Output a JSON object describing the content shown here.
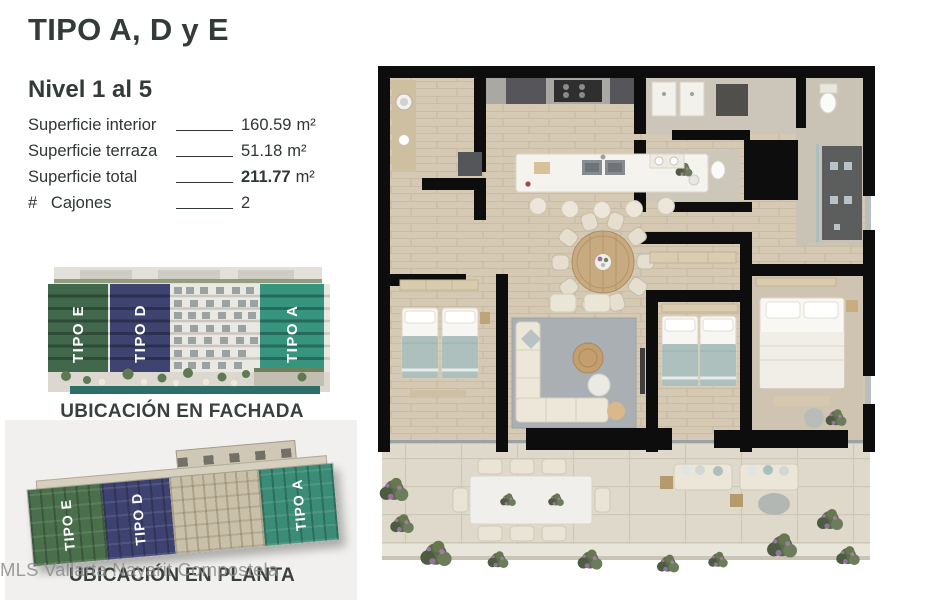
{
  "header": {
    "title": "TIPO A, D y E",
    "subtitle": "Nivel 1 al 5"
  },
  "specs": [
    {
      "label": "Superficie interior",
      "value": "160.59",
      "unit": "m²"
    },
    {
      "label": "Superficie terraza",
      "value": "51.18",
      "unit": "m²"
    },
    {
      "label": "Superficie total",
      "value": "211.77",
      "unit": "m²"
    },
    {
      "label": "#   Cajones",
      "value": "2",
      "unit": ""
    }
  ],
  "facade": {
    "caption": "UBICACIÓN EN FACHADA",
    "bands": [
      {
        "label": "TIPO E",
        "color": "#41684d"
      },
      {
        "label": "TIPO D",
        "color": "#3e4370"
      },
      {
        "label": "TIPO A",
        "color": "#37947e"
      }
    ]
  },
  "plan_locator": {
    "caption": "UBICACIÓN EN PLANTA",
    "bands": [
      {
        "label": "TIPO E",
        "color": "#4a6f4b"
      },
      {
        "label": "TIPO D",
        "color": "#3d4270"
      },
      {
        "label": "TIPO A",
        "color": "#3a8c76"
      }
    ]
  },
  "watermark": "MLS Vallarta Nayarit Compostela",
  "colors": {
    "heading_text": "#333b38",
    "body_text": "#2f3634",
    "caption_text": "#39413d",
    "watermark_gray": "#8c8c8c",
    "wall_black": "#0d0d0d",
    "floor_beige": "#d6c9b3",
    "terrace_stone": "#ded9cb",
    "card_gray": "#f1f0ee"
  }
}
